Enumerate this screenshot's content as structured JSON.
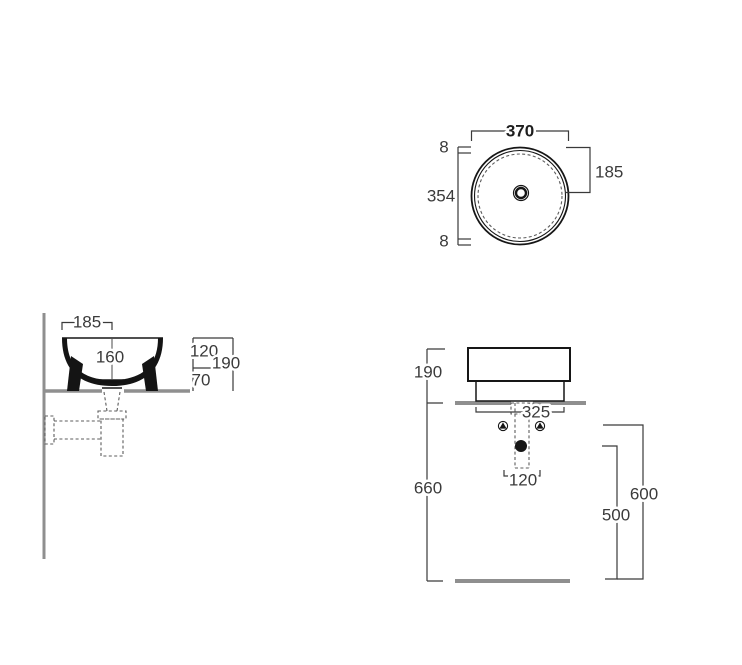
{
  "drawing": {
    "description": "Round countertop washbasin - technical dimension drawing, three views",
    "colors": {
      "line": "#161616",
      "dimension": "#3b3b3b",
      "architectural_gray": "#8f8f8f",
      "background": "#ffffff"
    },
    "top_view": {
      "outer_diameter": "370",
      "rim_thickness_top": "8",
      "inner_diameter": "354",
      "rim_thickness_bottom": "8",
      "radius_to_center": "185"
    },
    "side_view": {
      "edge_to_drain": "185",
      "inner_depth": "160",
      "bowl_height": "120",
      "total_height": "190",
      "foot_height": "70"
    },
    "front_view": {
      "height_above_counter": "190",
      "base_width": "325",
      "counter_height": "660",
      "trap_width": "120",
      "drain_outlet_height": "500",
      "valve_height": "600"
    }
  }
}
